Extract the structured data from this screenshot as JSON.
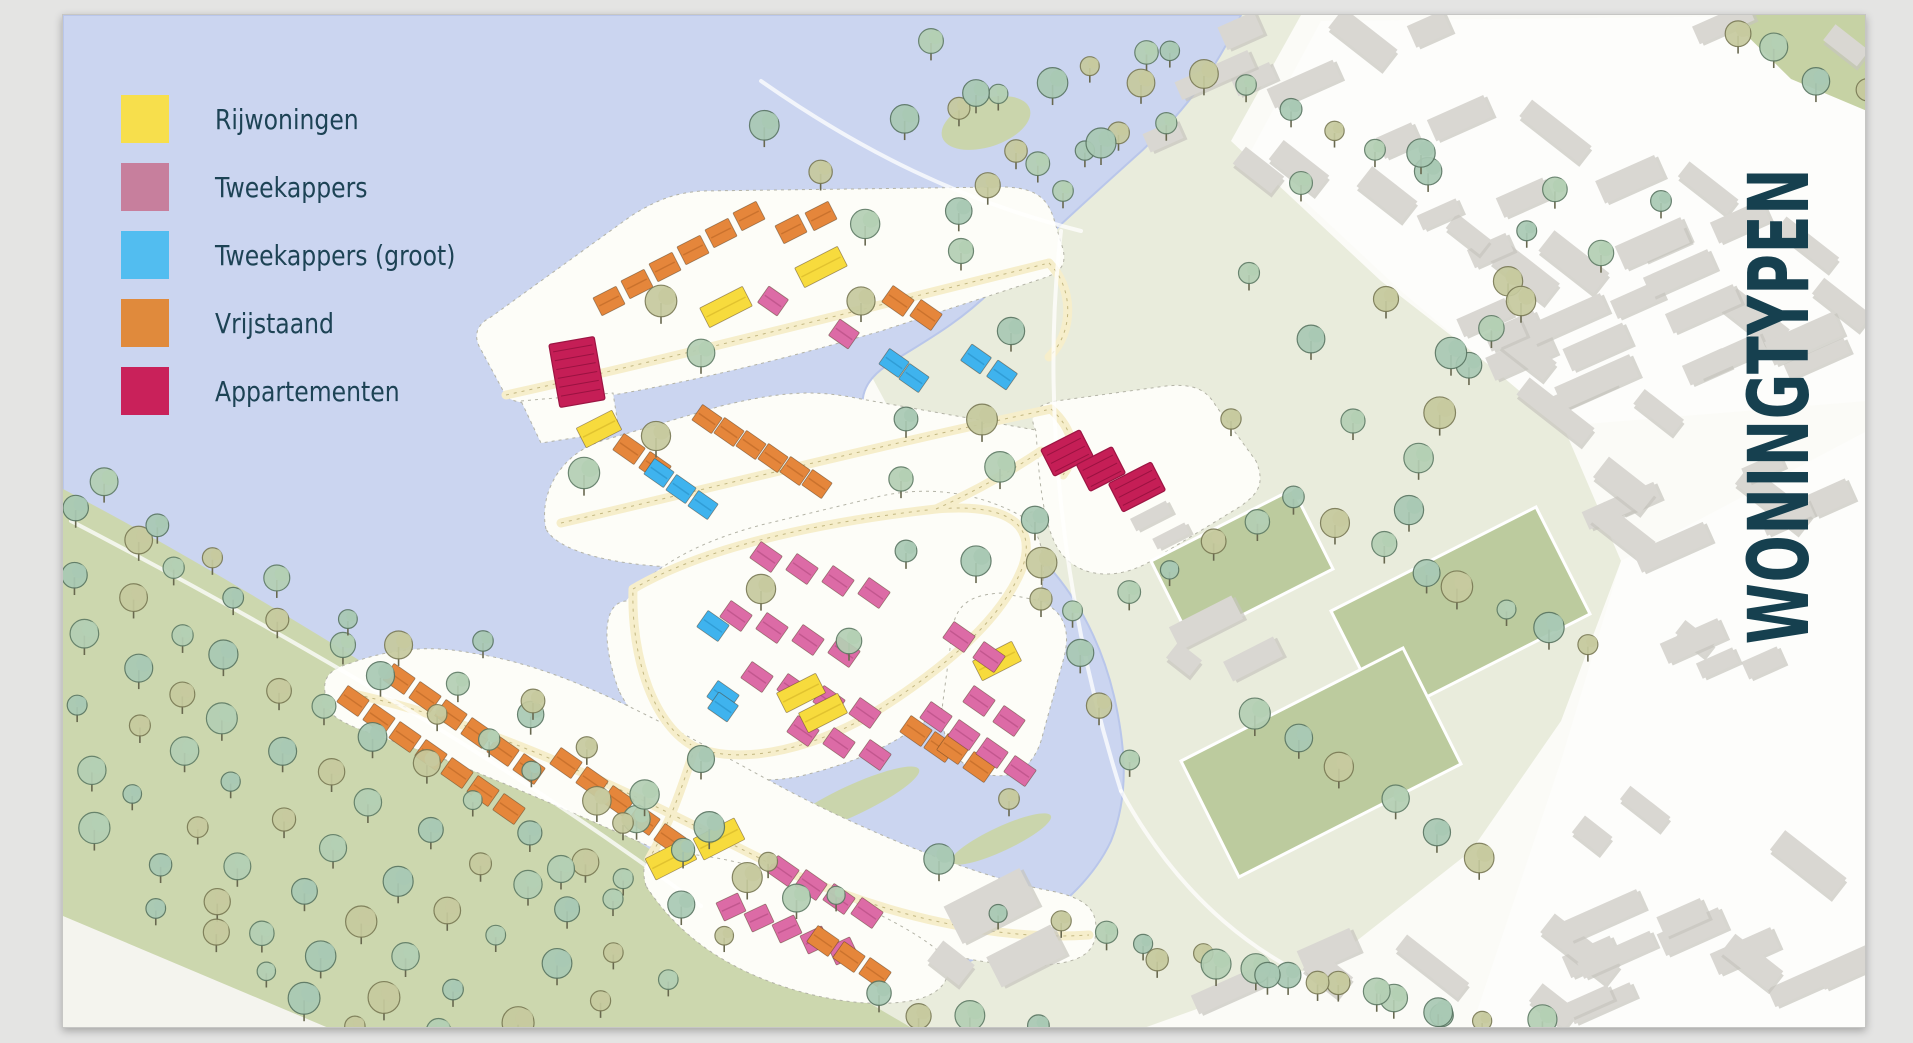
{
  "title": {
    "text": "WONINGTYPEN",
    "color": "#16404f"
  },
  "legend": {
    "text_color": "#1d4355",
    "items": [
      {
        "label": "Rijwoningen",
        "color": "#f7df4c"
      },
      {
        "label": "Tweekappers",
        "color": "#c77f9d"
      },
      {
        "label": "Tweekappers (groot)",
        "color": "#52bdf0"
      },
      {
        "label": "Vrijstaand",
        "color": "#e08a3c"
      },
      {
        "label": "Appartementen",
        "color": "#c9215a"
      }
    ]
  },
  "map": {
    "palette": {
      "water": "#cbd5f0",
      "water_edge": "#b9c6ea",
      "sage": "#e9ecdc",
      "park": "#ccd7ae",
      "reed": "#c9d5a8",
      "islet": "#dee3c8",
      "field": "#bccb9e",
      "field_line": "#ffffff",
      "island": "#fdfdf8",
      "island_edge": "#b3b3a6",
      "road": "#f6eecb",
      "road_dash": "#b5a96e",
      "path_white": "#ffffff",
      "gray_block": "#d9d7d2",
      "gray_shadow": "#c6c4be",
      "corner_green": "#c6d2a4",
      "corner_white": "#f4f4ee",
      "trunk": "#68684f"
    },
    "house_colors": {
      "Y": "#f7db3d",
      "P": "#dc6ba6",
      "B": "#3fb3ee",
      "O": "#e5863b",
      "A": "#c51e56"
    },
    "house_edges": {
      "Y": "#d9b92a",
      "P": "#b84f85",
      "B": "#2a94cc",
      "O": "#bf6a28",
      "A": "#9c1543"
    },
    "ground": {
      "sage": [
        "M640,14 L1300,14 L1230,140 L1380,280 L1560,420 L1620,560 L1560,720 L1470,850 L1330,960 L1140,1028 L860,1028 L880,850 L990,700 L1000,560 L900,430 L830,300 L710,130 Z"
      ],
      "white": [
        "M1320,20 L1858,14 L1866,14 L1866,400 L1560,425 L1400,290 L1250,150 Z",
        "M1620,560 L1866,430 L1866,1028 L1470,1028 L1560,760 Z"
      ],
      "corner_green": [
        "M1725,14 L1866,14 L1866,110 L1790,78 Z"
      ],
      "park": [
        "M62,488 C200,560 350,652 520,762 C640,842 760,922 850,990 C880,1010 900,1020 912,1028 L62,1028 Z"
      ],
      "corner_white": [
        "M62,915 L330,1028 L62,1028 Z"
      ]
    },
    "water": {
      "path": "M62,14 L1240,14 C1215,70 1180,115 1135,155 C1085,200 1030,250 990,290 C955,325 915,345 885,365 C860,382 855,405 870,425 C900,465 975,500 1030,548 C1072,585 1100,640 1113,695 C1125,748 1128,795 1110,840 C1082,900 1010,945 945,970 C890,992 845,1002 815,995 C770,985 730,950 670,908 C570,835 430,745 305,670 C215,617 135,563 62,523 Z"
    },
    "islands": [
      "M505,395 L478,345 C472,332 478,322 490,316 L630,215 C660,196 678,192 700,190 L1000,186 C1038,186 1046,200 1052,215 L1062,248 C1066,266 1058,272 1040,278 L880,330 C760,365 650,390 560,402 C530,404 512,402 505,395 Z",
      "M545,528 C538,496 556,455 600,440 L720,405 C790,388 820,390 860,398 L1040,430 C1072,440 1074,452 1068,470 L1050,505 C940,540 820,555 700,566 C640,568 560,556 545,528 Z",
      "M618,690 C600,640 602,602 625,600 C660,555 720,535 760,524 L880,495 C940,482 990,498 1020,515 C1042,530 1044,560 1042,580 C1038,615 1000,660 950,700 C900,742 860,760 800,775 C740,788 660,770 618,690 Z",
      "M950,640 C952,606 965,594 1000,592 L1040,600 C1065,612 1070,632 1062,660 L1040,740 C1028,776 1000,780 975,770 C948,758 938,730 942,700 Z",
      "M1035,430 C1026,412 1036,404 1055,400 L1165,385 C1195,382 1206,390 1215,405 L1255,460 C1264,482 1258,492 1240,505 L1150,560 C1112,582 1076,574 1060,552 C1042,528 1038,478 1035,430 Z",
      "M330,712 C318,682 322,670 350,662 C400,644 440,646 470,652 C560,665 650,715 760,775 C850,825 970,875 1050,890 C1090,898 1095,912 1095,928 C1095,950 1082,958 1060,962 C1000,972 920,950 800,912 C680,860 560,805 460,765 C395,738 348,730 330,712 Z",
      "M645,885 C638,860 648,852 675,852 C740,856 810,882 850,900 C905,925 935,945 945,958 C952,980 938,992 918,998 C870,1010 800,996 748,972 C700,950 668,920 645,885 Z",
      "M520,400 L612,392 L618,430 L540,442 Z"
    ],
    "reeds": [
      [
        700,
        765,
        60,
        13,
        -25
      ],
      [
        850,
        800,
        75,
        15,
        -25
      ],
      [
        1000,
        838,
        55,
        12,
        -25
      ],
      [
        585,
        715,
        34,
        9,
        -25
      ],
      [
        985,
        122,
        46,
        24,
        -18
      ]
    ],
    "fields": [
      "M1330,610 L1535,506 L1589,613 L1384,717 Z",
      "M1180,760 L1402,647 L1460,763 L1238,876 Z",
      "M1150,560 L1292,488 L1332,568 L1190,640 Z"
    ],
    "roads": [
      "M505,394 C650,362 830,316 1048,262",
      "M1048,262 C1072,286 1074,330 1048,356",
      "M560,522 C730,482 890,442 1050,408",
      "M1050,408 C1072,428 1078,452 1062,474",
      "M632,588 C700,548 810,522 935,508 C1010,502 1035,525 1022,565 C1003,615 950,662 882,706 C820,746 742,766 694,746 C654,726 630,660 632,588",
      "M348,692 C490,722 630,792 768,862 C886,918 1002,940 1088,934",
      "M935,508 C975,490 1010,470 1040,450",
      "M694,746 C680,790 668,824 648,858"
    ],
    "white_paths": [
      "M70,520 C300,640 520,770 700,905",
      "M760,80 C860,150 960,200 1080,230",
      "M1060,230 C1040,400 1060,600 1120,790",
      "M1120,790 C1180,900 1260,960 1340,990"
    ],
    "houses": {
      "clusters": [
        [
          "O",
          608,
          300,
          -27,
          6,
          28,
          -17,
          26,
          20
        ],
        [
          "O",
          790,
          228,
          -27,
          2,
          30,
          -13,
          26,
          20
        ],
        [
          "Y",
          725,
          306,
          -27,
          1,
          0,
          0,
          48,
          22
        ],
        [
          "Y",
          820,
          266,
          -27,
          1,
          0,
          0,
          48,
          22
        ],
        [
          "P",
          772,
          300,
          35,
          1,
          0,
          0,
          24,
          20
        ],
        [
          "P",
          843,
          333,
          35,
          1,
          0,
          0,
          24,
          20
        ],
        [
          "O",
          897,
          300,
          35,
          2,
          28,
          14,
          26,
          20
        ],
        [
          "B",
          975,
          358,
          35,
          2,
          26,
          16,
          24,
          20
        ],
        [
          "Y",
          598,
          428,
          -27,
          1,
          0,
          0,
          40,
          22
        ],
        [
          "O",
          628,
          448,
          35,
          2,
          26,
          18,
          26,
          20
        ],
        [
          "B",
          658,
          472,
          35,
          3,
          22,
          16,
          24,
          19
        ],
        [
          "O",
          706,
          418,
          35,
          6,
          22,
          13,
          24,
          19
        ],
        [
          "B",
          893,
          362,
          35,
          2,
          20,
          15,
          24,
          19
        ],
        [
          "P",
          765,
          556,
          35,
          4,
          36,
          12,
          26,
          20
        ],
        [
          "P",
          735,
          615,
          35,
          4,
          36,
          12,
          26,
          20
        ],
        [
          "P",
          756,
          676,
          35,
          4,
          36,
          12,
          26,
          20
        ],
        [
          "P",
          802,
          730,
          35,
          3,
          36,
          12,
          26,
          20
        ],
        [
          "Y",
          800,
          692,
          -27,
          1,
          0,
          0,
          44,
          22
        ],
        [
          "Y",
          996,
          660,
          -27,
          1,
          0,
          0,
          44,
          22
        ],
        [
          "B",
          712,
          625,
          35,
          1,
          0,
          0,
          26,
          20
        ],
        [
          "B",
          722,
          695,
          35,
          1,
          0,
          0,
          26,
          20
        ],
        [
          "O",
          915,
          730,
          35,
          2,
          24,
          16,
          26,
          20
        ],
        [
          "P",
          958,
          636,
          35,
          2,
          30,
          20,
          26,
          20
        ],
        [
          "P",
          978,
          700,
          35,
          2,
          30,
          20,
          26,
          20
        ],
        [
          "O",
          952,
          748,
          35,
          2,
          26,
          18,
          26,
          20
        ],
        [
          "O",
          352,
          700,
          35,
          7,
          26,
          18,
          26,
          20
        ],
        [
          "O",
          398,
          678,
          35,
          6,
          26,
          18,
          26,
          20
        ],
        [
          "O",
          565,
          762,
          35,
          5,
          26,
          19,
          26,
          20
        ],
        [
          "Y",
          670,
          858,
          -27,
          1,
          0,
          0,
          46,
          24
        ],
        [
          "Y",
          718,
          838,
          -27,
          1,
          0,
          0,
          46,
          24
        ],
        [
          "B",
          722,
          706,
          35,
          1,
          0,
          0,
          24,
          20
        ],
        [
          "Y",
          822,
          712,
          -27,
          1,
          0,
          0,
          44,
          22
        ],
        [
          "P",
          935,
          716,
          35,
          4,
          28,
          18,
          26,
          20
        ],
        [
          "P",
          782,
          870,
          35,
          4,
          28,
          14,
          26,
          20
        ],
        [
          "P",
          730,
          906,
          -25,
          5,
          28,
          11,
          24,
          20
        ],
        [
          "O",
          822,
          940,
          35,
          3,
          26,
          16,
          26,
          20
        ]
      ]
    },
    "apartments": {
      "tower": {
        "x": 576,
        "y": 371,
        "a": -10,
        "w": 46,
        "h": 64
      },
      "blocks": [
        {
          "x": 1066,
          "y": 452,
          "a": -27,
          "w": 44,
          "h": 30
        },
        {
          "x": 1100,
          "y": 468,
          "a": -27,
          "w": 40,
          "h": 30
        },
        {
          "x": 1136,
          "y": 486,
          "a": -27,
          "w": 48,
          "h": 32
        }
      ]
    },
    "gray": {
      "regions": [
        {
          "poly": [
            [
              1110,
              20
            ],
            [
              1858,
              20
            ],
            [
              1858,
              400
            ],
            [
              1560,
              425
            ],
            [
              1380,
              285
            ],
            [
              1235,
              150
            ]
          ],
          "n": 46,
          "seed": 7
        },
        {
          "poly": [
            [
              1600,
              470
            ],
            [
              1858,
              430
            ],
            [
              1858,
              1005
            ],
            [
              1480,
              1000
            ],
            [
              1560,
              760
            ]
          ],
          "n": 26,
          "seed": 13
        },
        {
          "poly": [
            [
              1180,
              960
            ],
            [
              1460,
              940
            ],
            [
              1720,
              1020
            ],
            [
              1240,
              1024
            ]
          ],
          "n": 7,
          "seed": 5
        }
      ],
      "blocks": [
        [
          1205,
          622,
          70,
          26,
          -27
        ],
        [
          1252,
          658,
          56,
          22,
          -27
        ],
        [
          1183,
          658,
          30,
          20,
          38
        ],
        [
          990,
          905,
          85,
          42,
          -27
        ],
        [
          1025,
          955,
          72,
          34,
          -27
        ],
        [
          950,
          962,
          40,
          26,
          38
        ],
        [
          1162,
          135,
          36,
          20,
          -24
        ],
        [
          1150,
          515,
          40,
          14,
          -27
        ],
        [
          1170,
          535,
          36,
          12,
          -27
        ]
      ]
    },
    "trees": {
      "variants": [
        [
          "#a9c9b4",
          "#5a7663"
        ],
        [
          "#c6ca9e",
          "#7a7a55"
        ],
        [
          "#b4cfb4",
          "#5f7c66"
        ]
      ],
      "belts": [
        [
          80,
          510,
          790,
          905,
          15
        ],
        [
          80,
          570,
          730,
          940,
          14
        ],
        [
          80,
          632,
          668,
          972,
          13
        ],
        [
          80,
          697,
          600,
          1000,
          11
        ],
        [
          82,
          762,
          515,
          1018,
          9
        ],
        [
          100,
          830,
          430,
          1022,
          7
        ],
        [
          160,
          905,
          360,
          1026,
          5
        ],
        [
          95,
          483,
          830,
          888,
          13
        ],
        [
          905,
          120,
          1140,
          55,
          6
        ],
        [
          950,
          205,
          1165,
          115,
          6
        ],
        [
          770,
          120,
          860,
          230,
          3
        ],
        [
          1160,
          45,
          1420,
          165,
          7
        ],
        [
          1735,
          30,
          1858,
          95,
          4
        ],
        [
          1550,
          185,
          1400,
          505,
          8
        ],
        [
          1335,
          522,
          1590,
          650,
          7
        ],
        [
          1258,
          705,
          1478,
          858,
          6
        ],
        [
          1120,
          585,
          1298,
          492,
          5
        ],
        [
          985,
          415,
          1125,
          755,
          8
        ],
        [
          1005,
          915,
          1440,
          1008,
          10
        ],
        [
          1150,
          955,
          1545,
          1026,
          8
        ],
        [
          870,
          1000,
          1030,
          1024,
          4
        ]
      ],
      "singles": [
        [
          660,
          300
        ],
        [
          700,
          352
        ],
        [
          905,
          418
        ],
        [
          760,
          588
        ],
        [
          848,
          640
        ],
        [
          700,
          758
        ],
        [
          622,
          822
        ],
        [
          560,
          868
        ],
        [
          975,
          560
        ],
        [
          1040,
          598
        ],
        [
          900,
          478
        ],
        [
          482,
          640
        ],
        [
          532,
          700
        ],
        [
          612,
          898
        ],
        [
          938,
          858
        ],
        [
          1008,
          798
        ],
        [
          930,
          40
        ],
        [
          975,
          92
        ],
        [
          1015,
          150
        ],
        [
          1062,
          190
        ],
        [
          1100,
          142
        ],
        [
          1140,
          82
        ],
        [
          1248,
          272
        ],
        [
          1310,
          338
        ],
        [
          1385,
          298
        ],
        [
          1300,
          182
        ],
        [
          1420,
          152
        ],
        [
          1230,
          418
        ],
        [
          1352,
          420
        ],
        [
          1450,
          352
        ],
        [
          1520,
          300
        ],
        [
          1600,
          252
        ],
        [
          1660,
          200
        ],
        [
          655,
          435
        ],
        [
          583,
          472
        ],
        [
          905,
          550
        ],
        [
          860,
          300
        ],
        [
          960,
          250
        ],
        [
          1010,
          330
        ]
      ]
    }
  }
}
